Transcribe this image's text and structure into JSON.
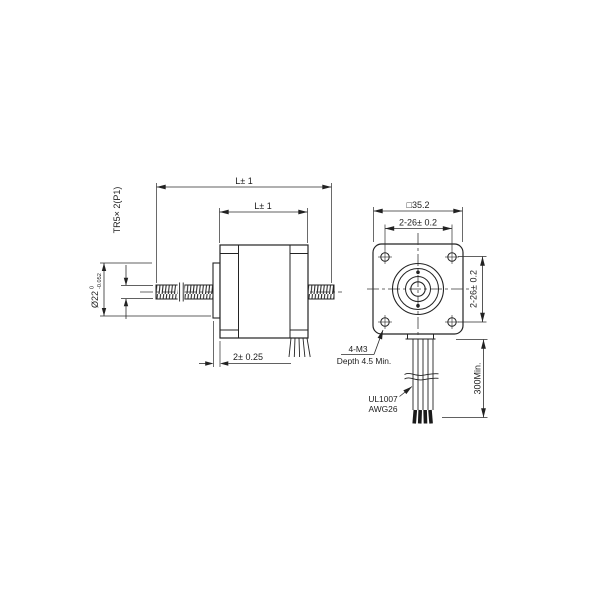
{
  "drawing": {
    "side_view": {
      "dim_overall_length": "L± 1",
      "dim_body_length": "L± 1",
      "thread_spec": "TR5× 2(P1)",
      "boss_diameter": "Ø22",
      "boss_diameter_tol_upper": "0",
      "boss_diameter_tol_lower": "-0.052",
      "boss_length": "2± 0.25"
    },
    "front_view": {
      "flange_size": "□35.2",
      "hole_spacing_horizontal": "2-26± 0.2",
      "hole_spacing_vertical": "2-26± 0.2",
      "mounting_holes_line1": "4-M3",
      "mounting_holes_line2": "Depth 4.5 Min.",
      "wire_spec_line1": "UL1007",
      "wire_spec_line2": "AWG26",
      "wire_length": "300Min."
    }
  }
}
